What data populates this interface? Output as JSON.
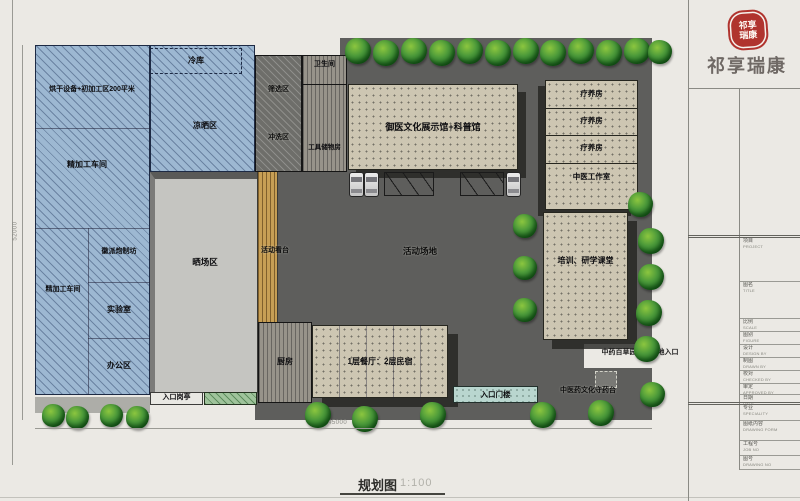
{
  "header": {
    "brand": "祁享瑞康",
    "seal_line1": "祁享",
    "seal_line2": "瑞康"
  },
  "caption": {
    "name": "规划图",
    "scale": "1:100"
  },
  "dims": {
    "site_height": "52000",
    "site_width": "45000"
  },
  "zones": {
    "cold_storage": "冷库",
    "drying": "烘干设备+初加工区200平米",
    "airing": "凉晒区",
    "fine_workshop_top": "精加工车间",
    "hui_workshop": "徽派炮制坊",
    "fine_workshop_bottom": "精加工车间",
    "lab": "实验室",
    "office": "办公区",
    "sun_yard": "晒场区",
    "entry_booth": "入口岗亭",
    "screening": "筛选区",
    "rinsing": "冲洗区",
    "toilet": "卫生间",
    "tool_room": "工具储物房",
    "exhibition": "御医文化展示馆+科普馆",
    "stand": "活动看台",
    "ground": "活动场地",
    "rehab1": "疗养房",
    "rehab2": "疗养房",
    "rehab3": "疗养房",
    "tcm_studio": "中医工作室",
    "training": "培训、研学课堂",
    "herb_entry": "中药百草园示范基地入口",
    "herb_stand": "中医药文化守药台",
    "gate": "入口门楼",
    "kitchen": "厨房",
    "restaurant": "1层餐厅：2层民宿"
  },
  "titleblock": {
    "rows": [
      {
        "zh": "项目",
        "en": "PROJECT"
      },
      {
        "zh": "图名",
        "en": "TITLE"
      },
      {
        "zh": "比例",
        "en": "SCALE"
      },
      {
        "zh": "图别",
        "en": "FIGURE"
      },
      {
        "zh": "设计",
        "en": "DESIGN BY"
      },
      {
        "zh": "制图",
        "en": "DRAWN BY"
      },
      {
        "zh": "校对",
        "en": "CHECKED BY"
      },
      {
        "zh": "审定",
        "en": "APPROVED BY"
      },
      {
        "zh": "日期",
        "en": "DATE"
      },
      {
        "zh": "专业",
        "en": "SPECIALITY"
      },
      {
        "zh": "图纸内容",
        "en": "DRAWING FORM"
      },
      {
        "zh": "工程号",
        "en": "JOB NO"
      },
      {
        "zh": "图号",
        "en": "DRAWING NO"
      }
    ]
  },
  "colors": {
    "seal_red": "#b0342e",
    "blue_hatch": "#9db8d2",
    "pavement": "#5e5e5c",
    "beige": "#cdc6b2",
    "tree_green": "#2e7d32",
    "wood_deck": "#c79f55"
  }
}
